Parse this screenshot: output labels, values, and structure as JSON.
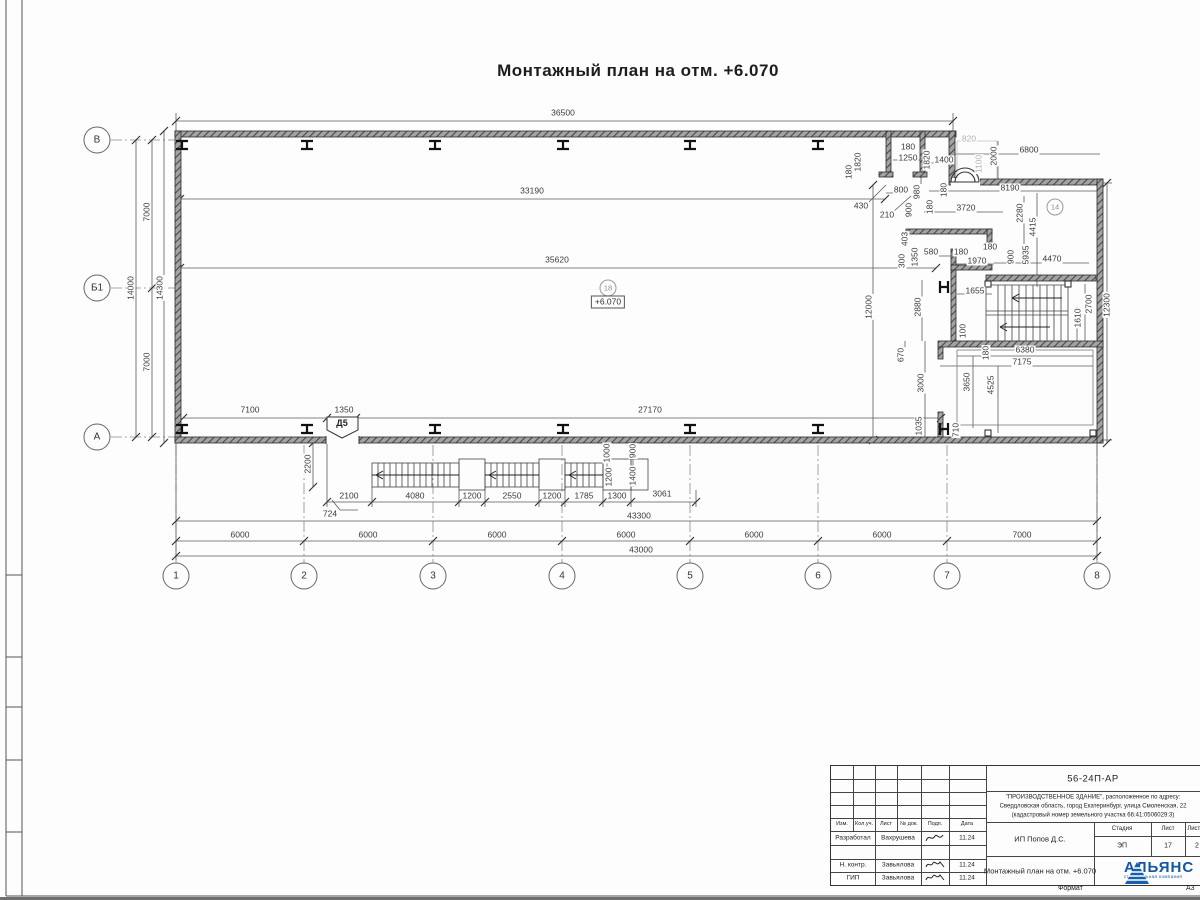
{
  "plan": {
    "title": "Монтажный план на отм. +6.070",
    "elevation": "+6.070",
    "door_tag": "Д5",
    "room_tags": [
      {
        "label": "18",
        "x": 608,
        "y": 288
      },
      {
        "label": "14",
        "x": 1055,
        "y": 207
      }
    ],
    "axes_bottom": [
      {
        "label": "1",
        "x": 176
      },
      {
        "label": "2",
        "x": 304
      },
      {
        "label": "3",
        "x": 433
      },
      {
        "label": "4",
        "x": 562
      },
      {
        "label": "5",
        "x": 690
      },
      {
        "label": "6",
        "x": 818
      },
      {
        "label": "7",
        "x": 947
      },
      {
        "label": "8",
        "x": 1097
      }
    ],
    "axes_left": [
      {
        "label": "В",
        "y": 140
      },
      {
        "label": "Б1",
        "y": 288
      },
      {
        "label": "А",
        "y": 437
      }
    ],
    "dim_labels": [
      {
        "t": "36500",
        "x": 563,
        "y": 113
      },
      {
        "t": "33190",
        "x": 532,
        "y": 191
      },
      {
        "t": "35620",
        "x": 557,
        "y": 260
      },
      {
        "t": "7100",
        "x": 250,
        "y": 410
      },
      {
        "t": "1350",
        "x": 344,
        "y": 410
      },
      {
        "t": "27170",
        "x": 650,
        "y": 410
      },
      {
        "t": "7000",
        "x": 147,
        "y": 212,
        "r": 1
      },
      {
        "t": "7000",
        "x": 147,
        "y": 362,
        "r": 1
      },
      {
        "t": "14000",
        "x": 131,
        "y": 288,
        "r": 1
      },
      {
        "t": "14300",
        "x": 160,
        "y": 288,
        "r": 1
      },
      {
        "t": "2200",
        "x": 308,
        "y": 464,
        "r": 1
      },
      {
        "t": "2100",
        "x": 349,
        "y": 496
      },
      {
        "t": "4080",
        "x": 415,
        "y": 496
      },
      {
        "t": "1200",
        "x": 472,
        "y": 496
      },
      {
        "t": "2550",
        "x": 512,
        "y": 496
      },
      {
        "t": "1200",
        "x": 552,
        "y": 496
      },
      {
        "t": "1785",
        "x": 584,
        "y": 496
      },
      {
        "t": "1300",
        "x": 617,
        "y": 496
      },
      {
        "t": "3061",
        "x": 662,
        "y": 494
      },
      {
        "t": "724",
        "x": 330,
        "y": 514
      },
      {
        "t": "1000",
        "x": 607,
        "y": 453,
        "r": 1
      },
      {
        "t": "900",
        "x": 633,
        "y": 451,
        "r": 1
      },
      {
        "t": "1200",
        "x": 609,
        "y": 477,
        "r": 1
      },
      {
        "t": "1400",
        "x": 633,
        "y": 476,
        "r": 1
      },
      {
        "t": "43300",
        "x": 639,
        "y": 516
      },
      {
        "t": "6000",
        "x": 240,
        "y": 535
      },
      {
        "t": "6000",
        "x": 368,
        "y": 535
      },
      {
        "t": "6000",
        "x": 497,
        "y": 535
      },
      {
        "t": "6000",
        "x": 626,
        "y": 535
      },
      {
        "t": "6000",
        "x": 754,
        "y": 535
      },
      {
        "t": "6000",
        "x": 882,
        "y": 535
      },
      {
        "t": "7000",
        "x": 1022,
        "y": 535
      },
      {
        "t": "43000",
        "x": 641,
        "y": 550
      },
      {
        "t": "1820",
        "x": 858,
        "y": 162,
        "r": 1
      },
      {
        "t": "180",
        "x": 849,
        "y": 172,
        "r": 1
      },
      {
        "t": "180",
        "x": 908,
        "y": 147
      },
      {
        "t": "1250",
        "x": 908,
        "y": 158
      },
      {
        "t": "1820",
        "x": 927,
        "y": 160,
        "r": 1
      },
      {
        "t": "1400",
        "x": 944,
        "y": 160
      },
      {
        "t": "820",
        "x": 969,
        "y": 139,
        "g": 1
      },
      {
        "t": "1100",
        "x": 979,
        "y": 164,
        "r": 1,
        "g": 1
      },
      {
        "t": "2000",
        "x": 994,
        "y": 156,
        "r": 1
      },
      {
        "t": "6800",
        "x": 1029,
        "y": 150
      },
      {
        "t": "8190",
        "x": 1010,
        "y": 188
      },
      {
        "t": "2280",
        "x": 1020,
        "y": 213,
        "r": 1
      },
      {
        "t": "3720",
        "x": 966,
        "y": 208
      },
      {
        "t": "800",
        "x": 901,
        "y": 190
      },
      {
        "t": "430",
        "x": 861,
        "y": 206
      },
      {
        "t": "210",
        "x": 887,
        "y": 215
      },
      {
        "t": "980",
        "x": 917,
        "y": 192,
        "r": 1
      },
      {
        "t": "180",
        "x": 944,
        "y": 190,
        "r": 1
      },
      {
        "t": "900",
        "x": 909,
        "y": 210,
        "r": 1
      },
      {
        "t": "180",
        "x": 930,
        "y": 207,
        "r": 1
      },
      {
        "t": "403",
        "x": 905,
        "y": 239,
        "r": 1
      },
      {
        "t": "300",
        "x": 902,
        "y": 261,
        "r": 1
      },
      {
        "t": "1350",
        "x": 915,
        "y": 257,
        "r": 1
      },
      {
        "t": "580",
        "x": 931,
        "y": 252
      },
      {
        "t": "180",
        "x": 961,
        "y": 252
      },
      {
        "t": "1970",
        "x": 977,
        "y": 261
      },
      {
        "t": "180",
        "x": 990,
        "y": 247
      },
      {
        "t": "900",
        "x": 1011,
        "y": 257,
        "r": 1
      },
      {
        "t": "5935",
        "x": 1026,
        "y": 255,
        "r": 1
      },
      {
        "t": "4415",
        "x": 1033,
        "y": 227,
        "r": 1
      },
      {
        "t": "4470",
        "x": 1052,
        "y": 259
      },
      {
        "t": "1655",
        "x": 975,
        "y": 291
      },
      {
        "t": "12000",
        "x": 869,
        "y": 307,
        "r": 1
      },
      {
        "t": "2880",
        "x": 918,
        "y": 307,
        "r": 1
      },
      {
        "t": "2700",
        "x": 1089,
        "y": 304,
        "r": 1
      },
      {
        "t": "1610",
        "x": 1078,
        "y": 318,
        "r": 1
      },
      {
        "t": "12300",
        "x": 1107,
        "y": 305,
        "r": 1
      },
      {
        "t": "100",
        "x": 963,
        "y": 331,
        "r": 1
      },
      {
        "t": "180",
        "x": 986,
        "y": 353,
        "r": 1
      },
      {
        "t": "6380",
        "x": 1025,
        "y": 350
      },
      {
        "t": "7175",
        "x": 1022,
        "y": 362
      },
      {
        "t": "670",
        "x": 901,
        "y": 355,
        "r": 1
      },
      {
        "t": "3000",
        "x": 921,
        "y": 383,
        "r": 1
      },
      {
        "t": "3650",
        "x": 967,
        "y": 382,
        "r": 1
      },
      {
        "t": "4525",
        "x": 991,
        "y": 385,
        "r": 1
      },
      {
        "t": "1035",
        "x": 919,
        "y": 426,
        "r": 1
      },
      {
        "t": "710",
        "x": 956,
        "y": 430,
        "r": 1
      }
    ]
  },
  "titleblock": {
    "doc_number": "56-24П-АР",
    "project_line1": "\"ПРОИЗВОДСТВЕННОЕ ЗДАНИЕ\", расположенное по адресу:",
    "project_line2": "Свердловская область, город Екатеринбург, улица Смоленская, 22",
    "project_line3": "(кадастровый номер земельного участка 66:41:0506029:3)",
    "client": "ИП Попов Д.С.",
    "stage_label": "Стадия",
    "sheet_label": "Лист",
    "sheets_label": "Листов",
    "stage": "ЭП",
    "sheet_no": "17",
    "sheets_total": "2",
    "drawing_title": "Монтажный план на отм. +6.070",
    "company": "АЛЬЯНС",
    "company_tagline": "строительная компания",
    "columns": [
      "Изм.",
      "Кол.уч.",
      "Лист",
      "№ док.",
      "Подп.",
      "Дата"
    ],
    "signature_rows": [
      {
        "role": "Разработал",
        "name": "Вахрушева",
        "date": "11.24"
      },
      {
        "role": "",
        "name": "",
        "date": ""
      },
      {
        "role": "Н. контр.",
        "name": "Завьялова",
        "date": "11.24"
      },
      {
        "role": "ГИП",
        "name": "Завьялова",
        "date": "11.24"
      }
    ],
    "format_label": "Формат",
    "format_value": "А3"
  }
}
